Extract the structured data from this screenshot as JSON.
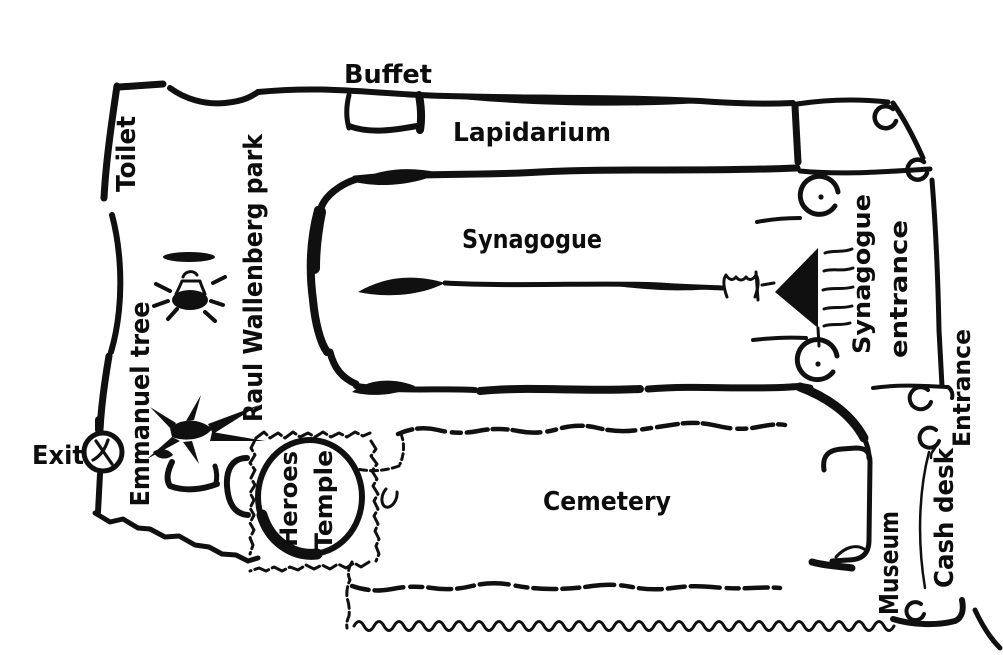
{
  "page": {
    "kind": "hand-drawn site map",
    "colors": {
      "ink": "#101010",
      "paper": "#ffffff"
    }
  },
  "labels": {
    "buffet": "Buffet",
    "lapidarium": "Lapidarium",
    "toilet": "Toilet",
    "raul_wallenberg_park": "Raul Wallenberg park",
    "synagogue": "Synagogue",
    "synagogue_entrance_line1": "Synagogue",
    "synagogue_entrance_line2": "entrance",
    "emmanuel_tree": "Emmanuel tree",
    "exit": "Exit",
    "heroes_temple_line1": "Heroes",
    "heroes_temple_line2": "Temple",
    "cemetery": "Cemetery",
    "museum": "Museum",
    "cash_desk": "Cash desk",
    "entrance": "Entrance"
  },
  "icons": {
    "exit_gate_icon": "circle with crossing strokes (gate/turnstile)",
    "fountain_icon": "park fountain: dish, pedestal, basin, splash dashes",
    "emmanuel_tree_icon": "weeping-willow / spiky tree silhouette",
    "bench_icon": "small L-shaped bench stroke",
    "buffet_stand_icon": "small open rectangle stand under wall",
    "synagogue_dome_north_icon": "circle with center dot",
    "synagogue_dome_south_icon": "circle with center dot",
    "synagogue_porch_icon": "solid triangle between the domes",
    "entrance_stairs_icon": "stacked squiggle strokes",
    "crown_icon": "small tulip/crown at end of interior line",
    "heroes_temple_dome_icon": "large circle inside stamp-border square",
    "roof_door_icon_1": "open circle, top-right roof corner",
    "roof_door_icon_2": "open circle, roof lower corner",
    "cash_desk_window_icon_1": "open circle near entrance corridor",
    "cash_desk_window_icon_2": "open circle with squiggle tail",
    "museum_door_icon": "open circle at museum bottom wall"
  }
}
